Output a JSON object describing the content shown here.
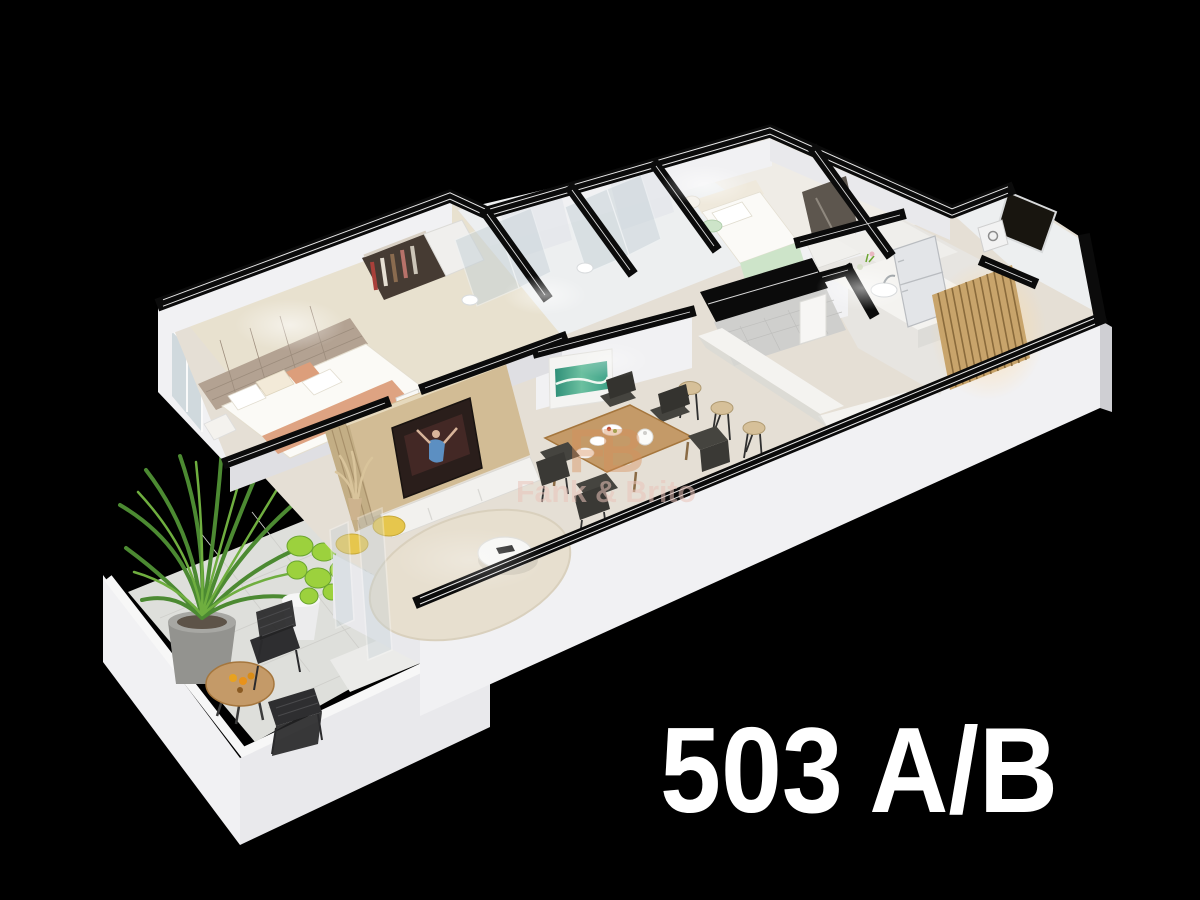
{
  "image": {
    "type": "3d-floor-plan-cutaway-render",
    "background": "#000000"
  },
  "unit_label": {
    "text": "503 A/B",
    "color": "#ffffff"
  },
  "watermark": {
    "logo_text": "FB",
    "brand_text": "Fank & Brito",
    "logo_color": "#d78f5a",
    "text_color": "#eac4ba"
  },
  "palette": {
    "bg": "#000000",
    "wall": "#f1f1f3",
    "wallFace": "#e9e9ec",
    "wallShade": "#dfdfe3",
    "cap": "#0b0b0b",
    "pin": "#ffffff",
    "floorMain": "#e5dfd5",
    "floorBedroom": "#e8e1cf",
    "floorMarble": "#edeff0",
    "floorKitchen": "#e7e5e1",
    "floorBalcony": "#dedfdb",
    "rug": "#e7dfcf",
    "woodPanel": "#d2bc95",
    "woodTable": "#c49a68",
    "woodSlats": "#c8a46b",
    "headboard": "#b3a292",
    "salmon": "#dc9e7b",
    "mint": "#cde4c9",
    "tealArt": "#3fa389",
    "pouf": "#e6c64d",
    "plantDark": "#4c8a32",
    "plantLight": "#9cd13d",
    "potGray": "#93938f",
    "glass": "#c4d0d6",
    "chairDark": "#45443f",
    "stoolSeat": "#d6c099",
    "fridge": "#e3e5e8",
    "counter": "#f4f3f0",
    "tvDark": "#2a1e1b",
    "wmLogo": "#d78f5a",
    "wmText": "#eac4ba",
    "label": "#ffffff"
  },
  "scene": {
    "style": "isometric cutaway apartment seen from above on black background",
    "rooms": [
      "master-bedroom",
      "bathroom-1",
      "bathroom-2",
      "bedroom-2",
      "kitchen",
      "dining-area",
      "living-room",
      "balcony",
      "service-area",
      "hallway"
    ],
    "furnishings": [
      "double-bed",
      "tufted-headboard",
      "wardrobe-closet",
      "glass-showers",
      "single-bed",
      "refrigerator",
      "kitchen-counter",
      "breakfast-bar",
      "bar-stools",
      "dining-table",
      "dining-chairs",
      "teal-wall-art",
      "tv-panel",
      "television",
      "yellow-poufs",
      "round-rug",
      "coffee-table",
      "potted-palm",
      "fiddle-leaf-plant",
      "bistro-table",
      "bistro-chairs",
      "wood-slat-partition",
      "balcony-step",
      "glass-door"
    ]
  }
}
